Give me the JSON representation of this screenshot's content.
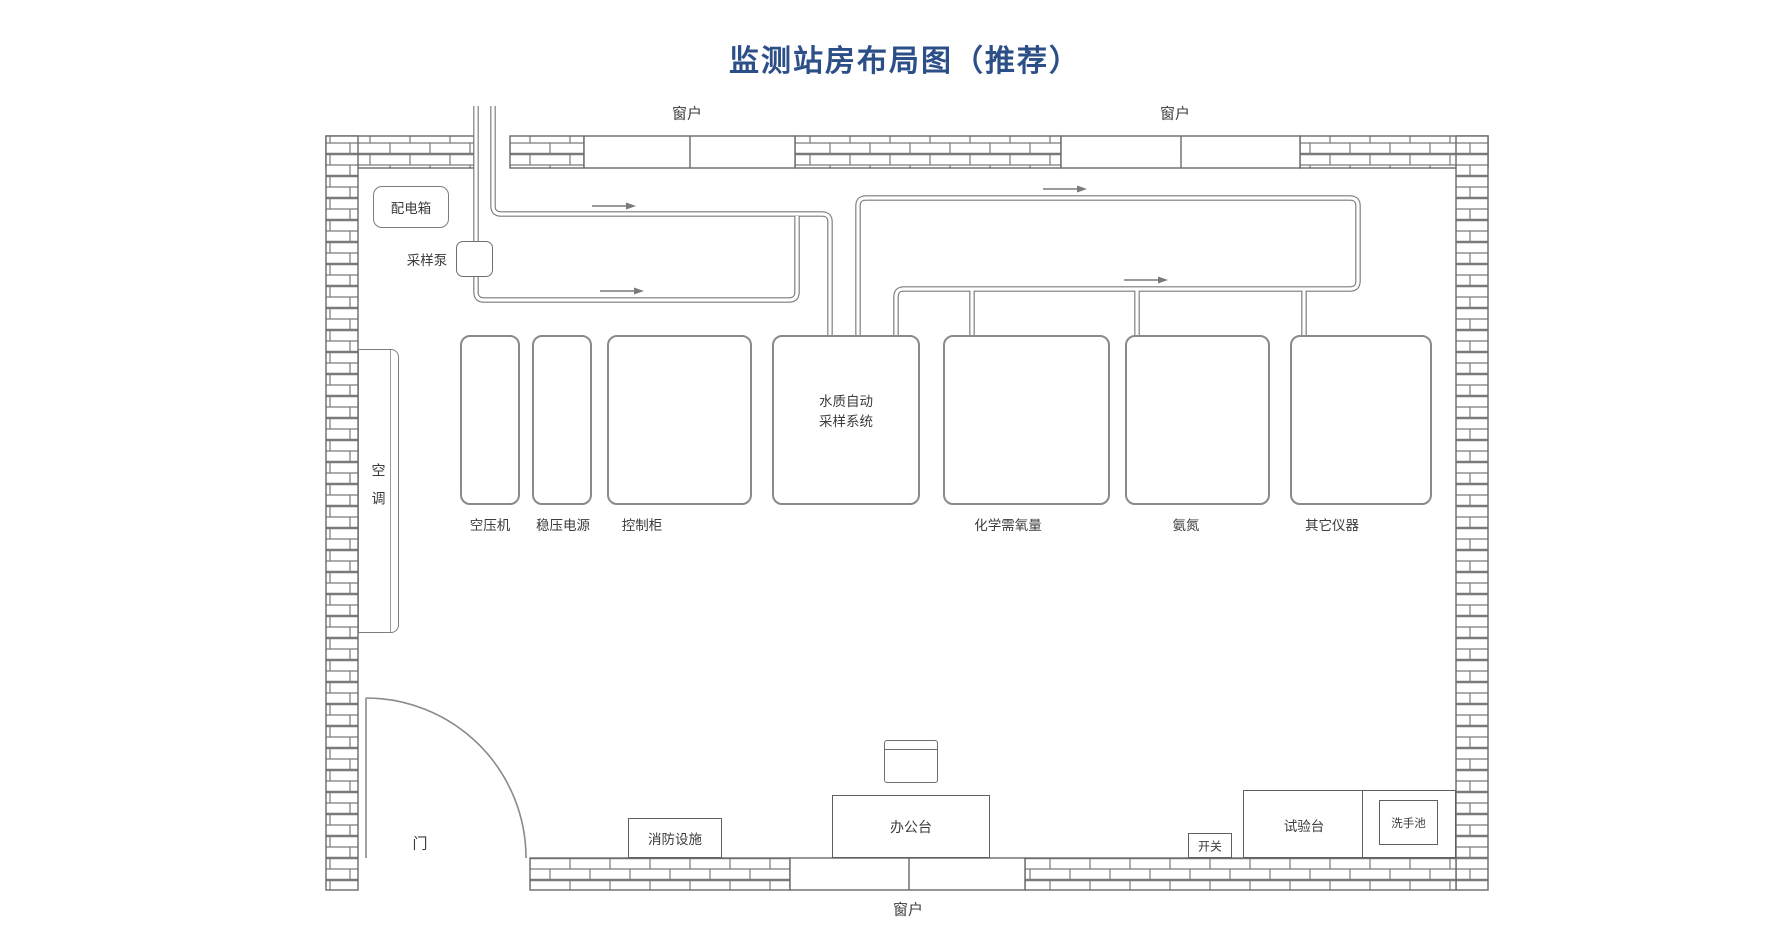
{
  "title": "监测站房布局图（推荐）",
  "colors": {
    "title_blue": "#2c4f87",
    "wall_line": "#6a6a6a",
    "pipe_line": "#777777",
    "text": "#3c3c3c"
  },
  "labels": {
    "window": "窗户",
    "door": "门",
    "distribution_box": "配电箱",
    "sampling_pump": "采样泵",
    "air_conditioner": "空调",
    "fire_equipment": "消防设施",
    "office_desk": "办公台",
    "switch": "开关",
    "test_bench": "试验台",
    "sink": "洗手池"
  },
  "equipment": [
    {
      "id": "air-compressor",
      "label": "空压机"
    },
    {
      "id": "voltage-stabilizer",
      "label": "稳压电源"
    },
    {
      "id": "control-cabinet",
      "label": "控制柜"
    },
    {
      "id": "water-sampling-system",
      "label": "水质自动采样系统",
      "label_lines": [
        "水质自动",
        "采样系统"
      ]
    },
    {
      "id": "cod-analyzer",
      "label": "化学需氧量"
    },
    {
      "id": "ammonia-analyzer",
      "label": "氨氮"
    },
    {
      "id": "other-instruments",
      "label": "其它仪器"
    }
  ]
}
